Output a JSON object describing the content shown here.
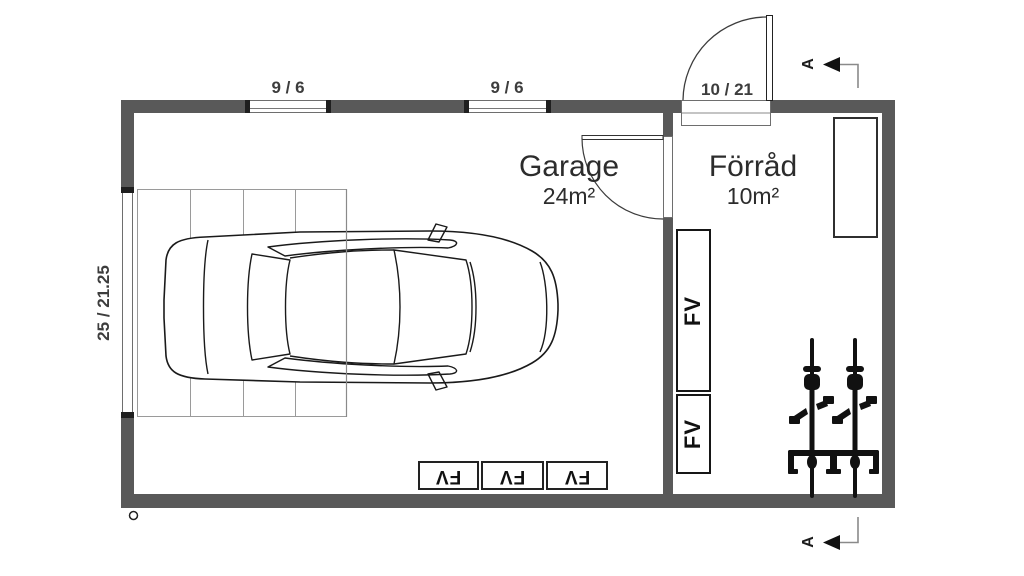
{
  "colors": {
    "wall": "#595959",
    "cap": "#1f1f1f",
    "line": "#3c3c3c",
    "muted_line": "#8a8a8a",
    "text": "#333333"
  },
  "rooms": {
    "garage": {
      "name": "Garage",
      "area": "24m²"
    },
    "storage": {
      "name": "Förråd",
      "area": "10m²"
    }
  },
  "dimensions": {
    "window_left": "9 / 6",
    "window_right": "9 / 6",
    "entry_door": "10 / 21",
    "garage_door": "25 / 21.25"
  },
  "fixtures": {
    "cabinet_tall_label": "FV",
    "cabinet_short_label": "FV",
    "floor_unit_1_label": "FV",
    "floor_unit_2_label": "FV",
    "floor_unit_3_label": "FV"
  },
  "section": {
    "marker_top": "A",
    "marker_bottom": "A"
  },
  "icons": {
    "car": "car-icon",
    "bicycles": "bicycle-icon",
    "entry_door_swing": "door-swing-arc",
    "interior_door_swing": "door-swing-arc",
    "section_arrow": "section-arrow-icon",
    "drain": "drain-marker-icon"
  }
}
